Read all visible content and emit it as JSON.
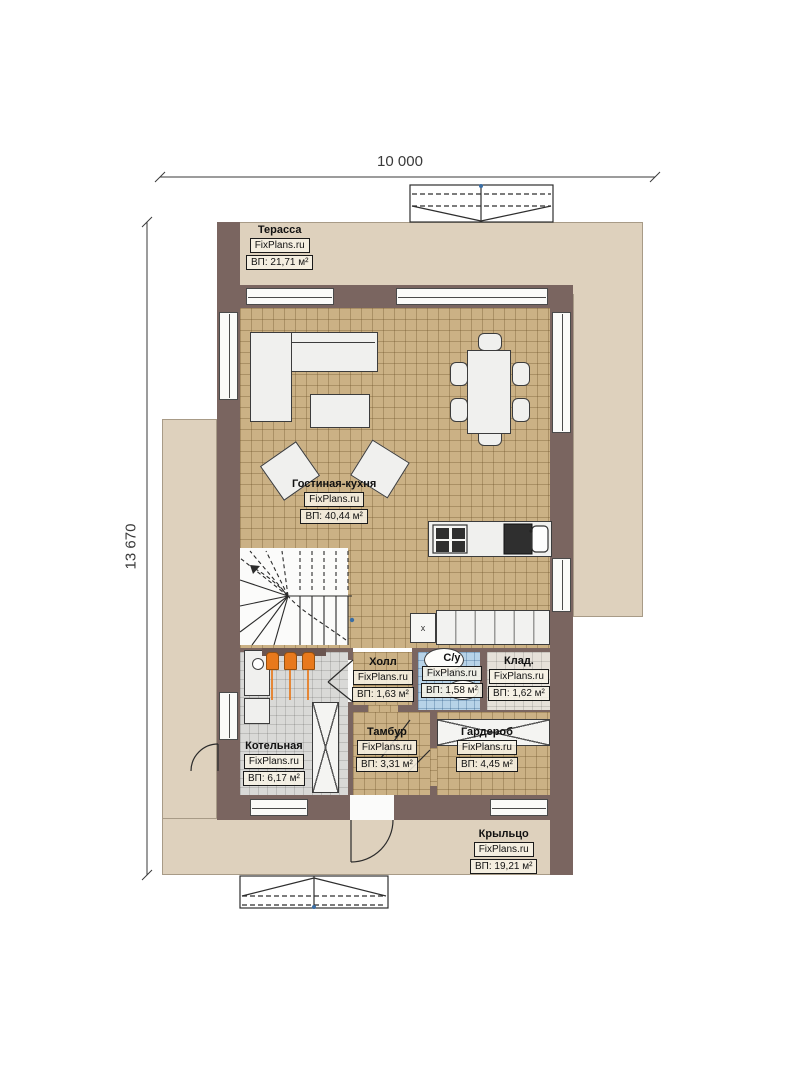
{
  "dimensions": {
    "top": "10 000",
    "left": "13 670"
  },
  "rooms": {
    "terrace": {
      "name": "Терасса",
      "brand": "FixPlans.ru",
      "area": "ВП: 21,71 м²"
    },
    "living": {
      "name": "Гостиная-кухня",
      "brand": "FixPlans.ru",
      "area": "ВП: 40,44 м²"
    },
    "hall": {
      "name": "Холл",
      "brand": "FixPlans.ru",
      "area": "ВП: 1,63 м²"
    },
    "wc": {
      "name": "С/у",
      "brand": "FixPlans.ru",
      "area": "ВП: 1,58 м²"
    },
    "storage": {
      "name": "Клад.",
      "brand": "FixPlans.ru",
      "area": "ВП: 1,62 м²"
    },
    "boiler": {
      "name": "Котельная",
      "brand": "FixPlans.ru",
      "area": "ВП: 6,17 м²"
    },
    "vestibule": {
      "name": "Тамбур",
      "brand": "FixPlans.ru",
      "area": "ВП: 3,31 м²"
    },
    "wardrobe": {
      "name": "Гардероб",
      "brand": "FixPlans.ru",
      "area": "ВП: 4,45 м²"
    },
    "porch": {
      "name": "Крыльцо",
      "brand": "FixPlans.ru",
      "area": "ВП: 19,21 м²"
    }
  },
  "markers": {
    "washer": "x"
  },
  "colors": {
    "wall": "#7a6560",
    "floor_tile": "#cbb185",
    "terrace": "#ded1bd",
    "boiler_floor": "#d9d9d7",
    "bath_tile": "#b7d3e8",
    "storage_floor": "#e6e1d9",
    "boiler_accent": "#e8791c"
  }
}
